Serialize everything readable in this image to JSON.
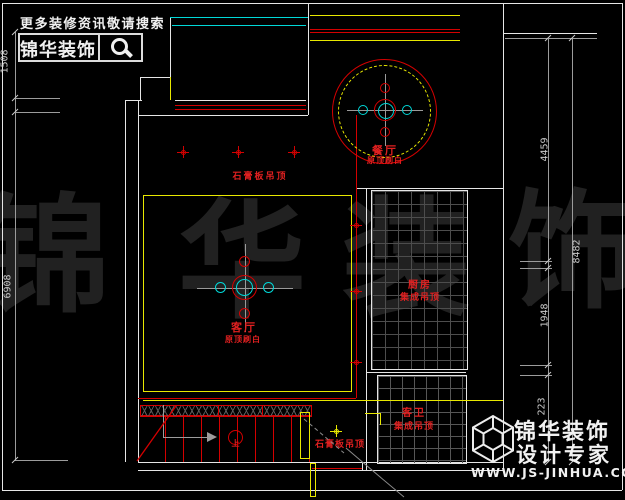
{
  "header": {
    "tagline": "更多装修资讯敬请搜索",
    "brand": "锦华装饰",
    "search_icon": "magnifier-icon"
  },
  "watermark": {
    "chars": [
      "锦",
      "华",
      "装",
      "饰"
    ]
  },
  "plan": {
    "rooms": {
      "dining": {
        "name": "餐厅",
        "note": "原顶刷白"
      },
      "living": {
        "name": "客厅",
        "note": "原顶刷白"
      },
      "kitchen": {
        "name": "厨房",
        "note": "集成吊顶"
      },
      "bath": {
        "name": "客卫",
        "note": "集成吊顶"
      }
    },
    "labels": {
      "gypsum_ceiling": "石膏板吊顶"
    },
    "stairs": {
      "direction": "上"
    }
  },
  "dimensions": {
    "left_top": "1508",
    "left_main": "6908",
    "right_a": "4459",
    "right_total": "8482",
    "right_b": "1948",
    "right_c": "223"
  },
  "footer": {
    "brand": "锦华装饰",
    "tagline": "设计专家",
    "url": "WWW.JS-JINHUA.COM"
  },
  "colors": {
    "background": "#000000",
    "wall": "#e6e6e6",
    "cad_red": "#d40000",
    "cad_yellow": "#e8e800",
    "cad_cyan": "#00d8d8",
    "dim_gray": "#9c9c9c",
    "label_red": "#e02020",
    "watermark": "#212121"
  }
}
